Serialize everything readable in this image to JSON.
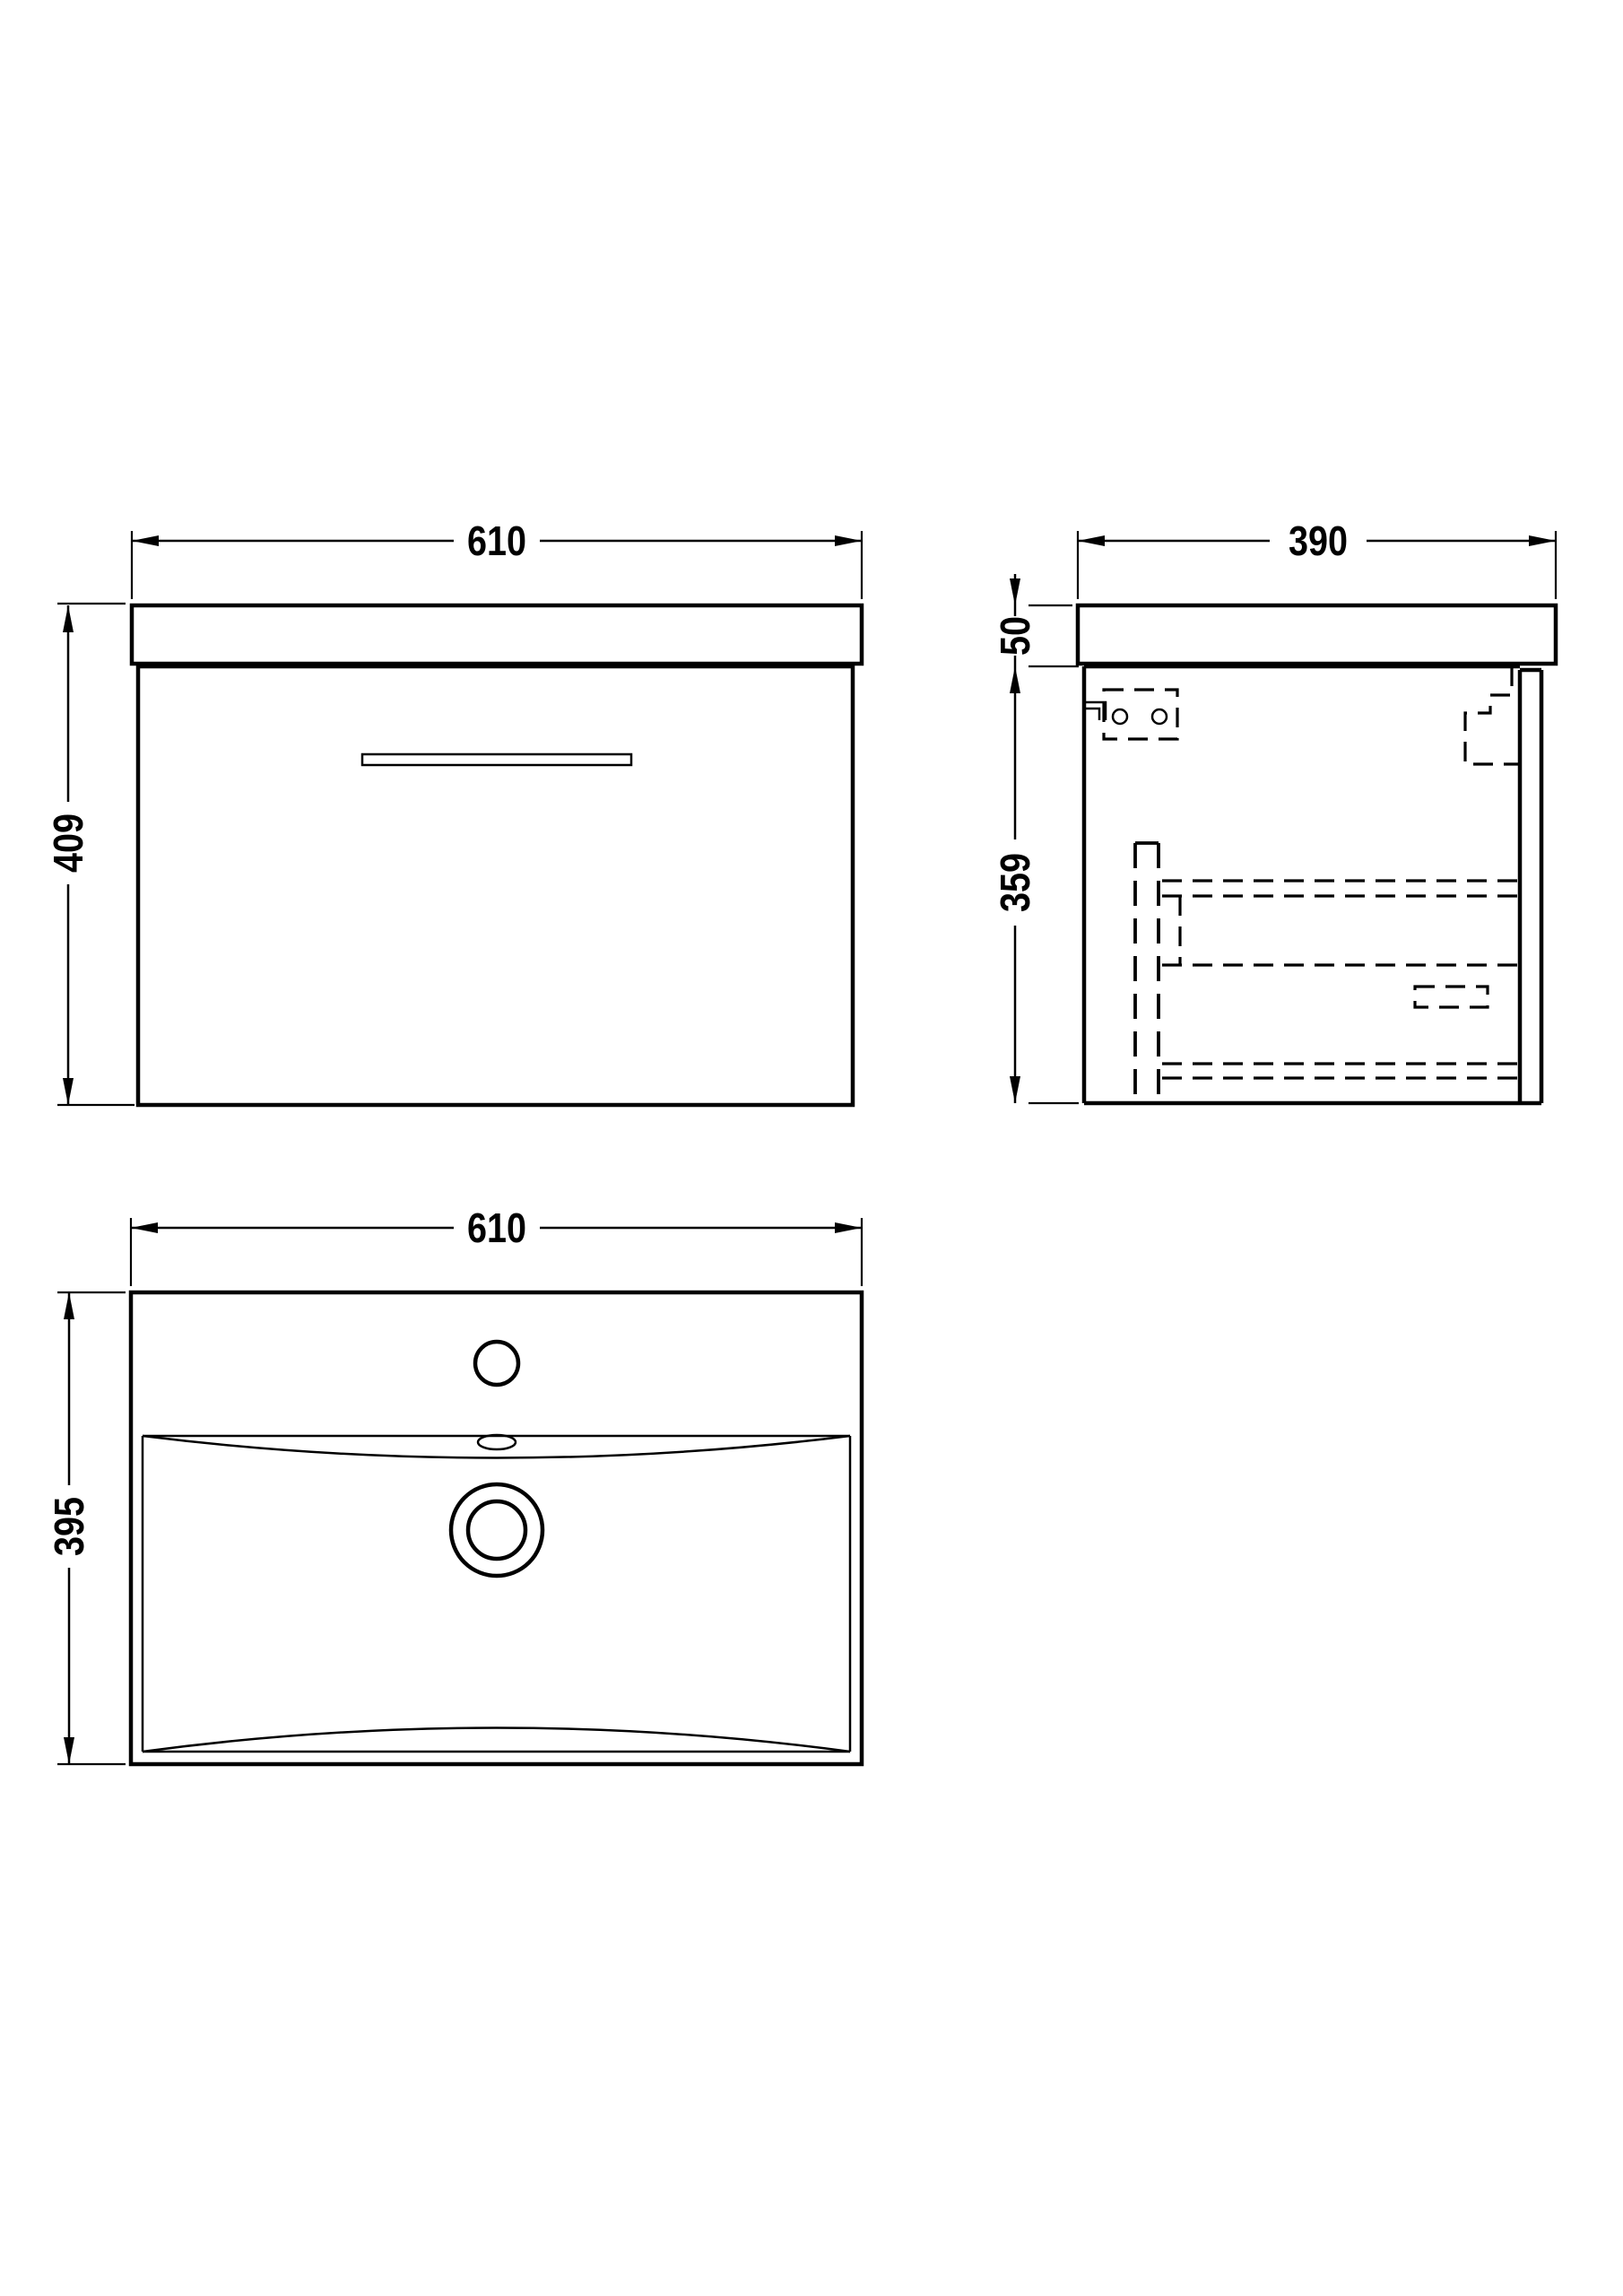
{
  "drawing": {
    "title": "wall-hung-vanity-unit-technical-drawing",
    "background_color": "#ffffff",
    "line_color": "#000000",
    "units": "mm"
  },
  "views": {
    "front": {
      "label": "front-elevation",
      "width_label": "610",
      "height_label": "409"
    },
    "side": {
      "label": "side-section",
      "depth_label": "390",
      "worktop_thickness_label": "50",
      "cabinet_height_label": "359"
    },
    "plan": {
      "label": "basin-plan",
      "width_label": "610",
      "depth_label": "395"
    }
  }
}
